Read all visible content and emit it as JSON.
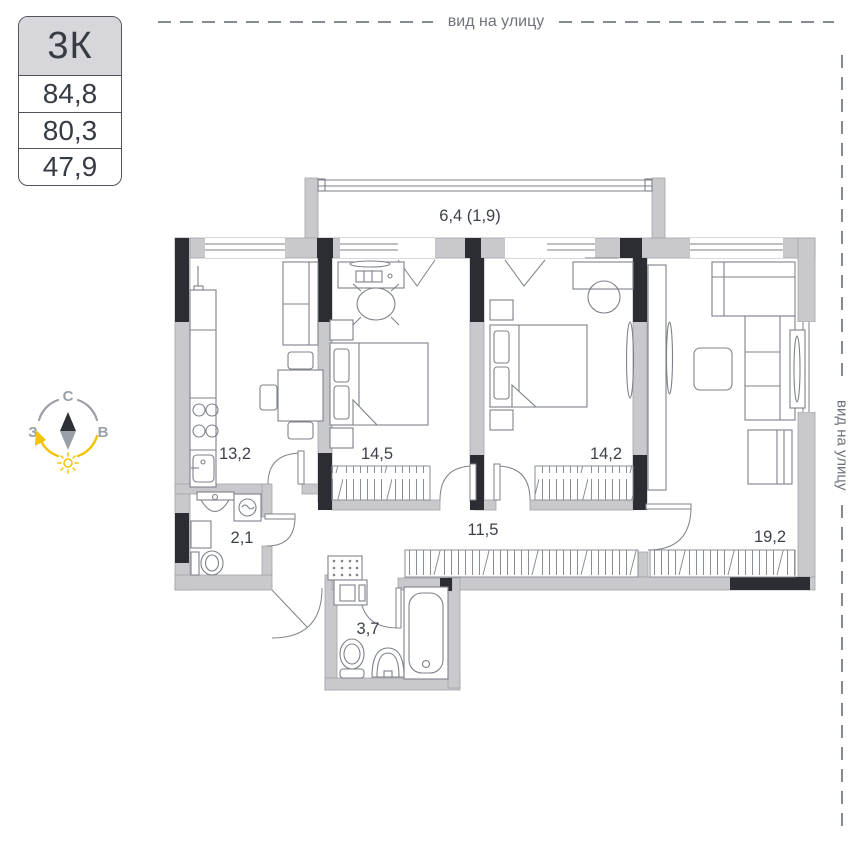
{
  "info_card": {
    "type_label": "3К",
    "rows": [
      "84,8",
      "80,3",
      "47,9"
    ]
  },
  "street_view_top": {
    "label": "вид на улицу"
  },
  "street_view_right": {
    "label": "вид на улицу"
  },
  "compass": {
    "north": "С",
    "west": "З",
    "east": "В"
  },
  "plan": {
    "rooms": [
      {
        "id": "balcony",
        "area_label": "6,4 (1,9)"
      },
      {
        "id": "kitchen",
        "area_label": "13,2"
      },
      {
        "id": "bedroom-1",
        "area_label": "14,5"
      },
      {
        "id": "bedroom-2",
        "area_label": "14,2"
      },
      {
        "id": "corridor",
        "area_label": "11,5"
      },
      {
        "id": "wc",
        "area_label": "2,1"
      },
      {
        "id": "living-room",
        "area_label": "19,2"
      },
      {
        "id": "bathroom",
        "area_label": "3,7"
      }
    ]
  },
  "colors": {
    "wall_gray": "#c9c9cd",
    "wall_dark": "#2b2d33",
    "line_gray": "#7d828a",
    "label_text": "#3c414a",
    "accent_yellow": "#f2c300",
    "muted_text": "#6f747c"
  }
}
